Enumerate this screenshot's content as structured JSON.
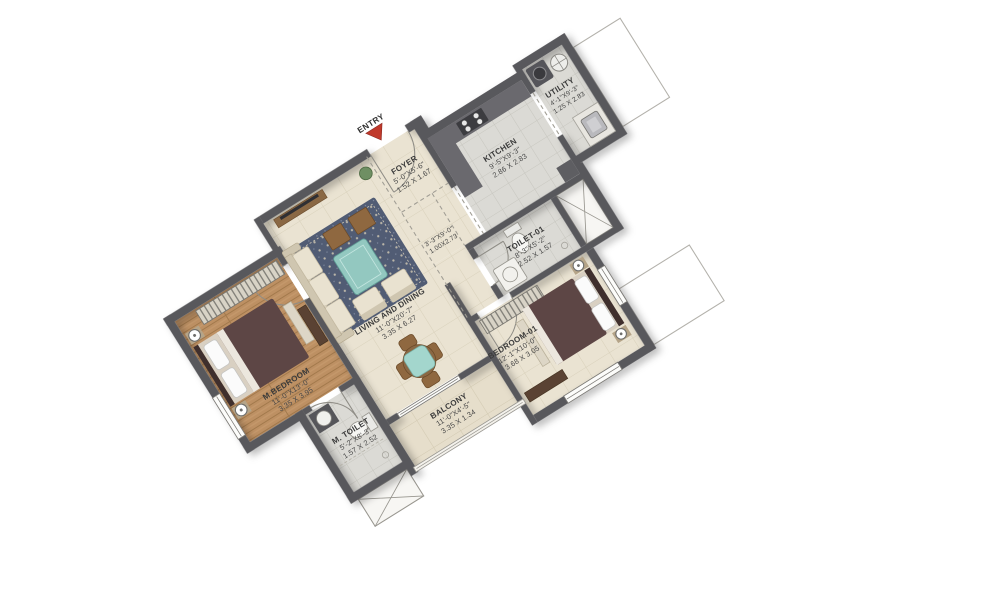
{
  "plan": {
    "entry": {
      "label": "ENTRY"
    },
    "rooms": {
      "foyer": {
        "name": "FOYER",
        "dims_ft": "5'-0\"X5'-6\"",
        "dims_m": "1.52 X 1.67"
      },
      "kitchen": {
        "name": "KITCHEN",
        "dims_ft": "9'-5\"X9'-3\"",
        "dims_m": "2.86 X 2.83"
      },
      "utility": {
        "name": "UTILITY",
        "dims_ft": "4'-1\"X9'-3\"",
        "dims_m": "1.25 X 2.83"
      },
      "passage": {
        "dims_ft": "3'-3\"X9'-0\"",
        "dims_m": "1.00X2.73"
      },
      "toilet01": {
        "name": "TOILET-01",
        "dims_ft": "8'-3\"X5'-2\"",
        "dims_m": "2.52 X 1.57"
      },
      "living": {
        "name": "LIVING AND DINING",
        "dims_ft": "11'-0\"X20'-7\"",
        "dims_m": "3.35 X 6.27"
      },
      "mbedroom": {
        "name": "M.BEDROOM",
        "dims_ft": "11'-0\"X13'-0\"",
        "dims_m": "3.35 X 3.95"
      },
      "mtoilet": {
        "name": "M. TOILET",
        "dims_ft": "5'-2\"X8'-3\"",
        "dims_m": "1.57 X 2.52"
      },
      "bedroom01": {
        "name": "BEDROOM-01",
        "dims_ft": "12'-1\"X10'-0\"",
        "dims_m": "3.68 X 3.05"
      },
      "balcony": {
        "name": "BALCONY",
        "dims_ft": "11'-0\"X4'-5\"",
        "dims_m": "3.35 X 1.34"
      }
    },
    "colors": {
      "wall": "#59585c",
      "entry_arrow_red": "#c0392b",
      "floor_beige": "#eae3d2",
      "floor_wood": "#bd9063",
      "floor_gray": "#dbdad5",
      "rug_navy": "#515c74",
      "teal": "#a3d6cd",
      "bed": "#5d4645",
      "counter_gray": "#6a696e"
    }
  }
}
